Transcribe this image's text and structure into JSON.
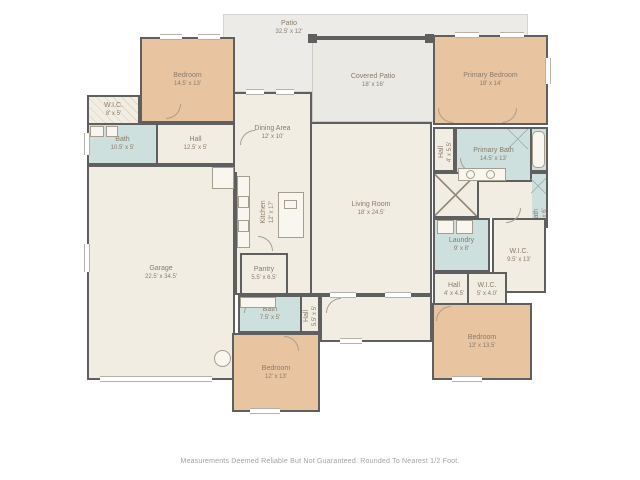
{
  "page": {
    "disclaimer": "Measurements Deemed Reliable But Not Guaranteed. Rounded To Nearest 1/2 Foot."
  },
  "palette": {
    "wall": "#5f5f5f",
    "interior": "#f2ede3",
    "bedroom": "#e9c4a1",
    "bath": "#cde0de",
    "outdoor": "#ecebe7",
    "label_text": "#8a7b6a",
    "disclaimer_text": "#a2a2a2"
  },
  "rooms": {
    "patio": {
      "name": "Patio",
      "dims": "32.5' x 12'"
    },
    "covered_patio": {
      "name": "Covered Patio",
      "dims": "18' x 16'"
    },
    "bedroom_tl": {
      "name": "Bedroom",
      "dims": "14.5' x 13'"
    },
    "wic_left": {
      "name": "W.I.C.",
      "dims": "8' x 5'"
    },
    "bath_left": {
      "name": "Bath",
      "dims": "10.5' x 5'"
    },
    "hall_left": {
      "name": "Hall",
      "dims": "12.5' x 5'"
    },
    "dining": {
      "name": "Dining Area",
      "dims": "12' x 10'"
    },
    "kitchen": {
      "name": "Kitchen",
      "dims": "12' x 17'"
    },
    "living": {
      "name": "Living Room",
      "dims": "18' x 24.5'"
    },
    "garage": {
      "name": "Garage",
      "dims": "22.5' x 34.5'"
    },
    "pantry": {
      "name": "Pantry",
      "dims": "5.5' x 6.5'"
    },
    "bath_bottom": {
      "name": "Bath",
      "dims": "7.5' x 5'"
    },
    "hall_bottom": {
      "name": "Hall",
      "dims": "5.5' x 5'"
    },
    "bedroom_bm": {
      "name": "Bedroom",
      "dims": "12' x 13'"
    },
    "primary_bedroom": {
      "name": "Primary Bedroom",
      "dims": "18' x 14'"
    },
    "hall_right": {
      "name": "Hall",
      "dims": "4' x 5.5'"
    },
    "primary_bath": {
      "name": "Primary Bath",
      "dims": "14.5' x 13'"
    },
    "bath_right": {
      "name": "Bath",
      "dims": "3' x 6'"
    },
    "laundry": {
      "name": "Laundry",
      "dims": "9' x 8'"
    },
    "wic_right": {
      "name": "W.I.C.",
      "dims": "9.5' x 13'"
    },
    "hall_small": {
      "name": "Hall",
      "dims": "4' x 4.5'"
    },
    "wic_small": {
      "name": "W.I.C.",
      "dims": "5' x 4.0'"
    },
    "bedroom_br": {
      "name": "Bedroom",
      "dims": "13' x 13.5'"
    }
  }
}
